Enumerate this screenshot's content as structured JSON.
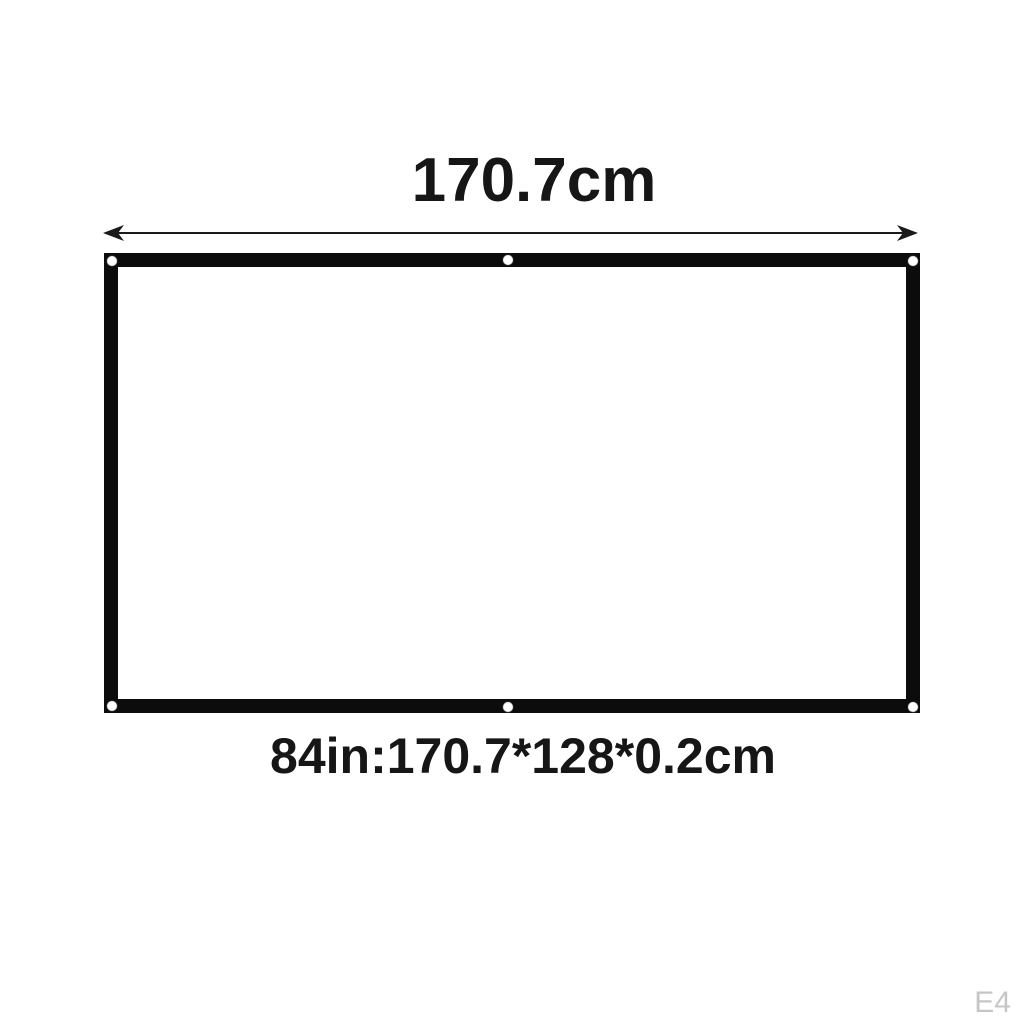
{
  "diagram": {
    "title": "170.7cm",
    "dimensions_label": "84in:170.7*128*0.2cm",
    "watermark": "E4",
    "screen": {
      "border_color": "#0c0c0c",
      "surface_color": "#ffffff",
      "grommet_count": 6,
      "grommet_positions": [
        "top-left",
        "top-center",
        "top-right",
        "bottom-left",
        "bottom-center",
        "bottom-right"
      ]
    },
    "colors": {
      "background": "#ffffff",
      "text": "#161616",
      "arrow": "#1a1a1a",
      "watermark": "#c6c6c6"
    }
  }
}
